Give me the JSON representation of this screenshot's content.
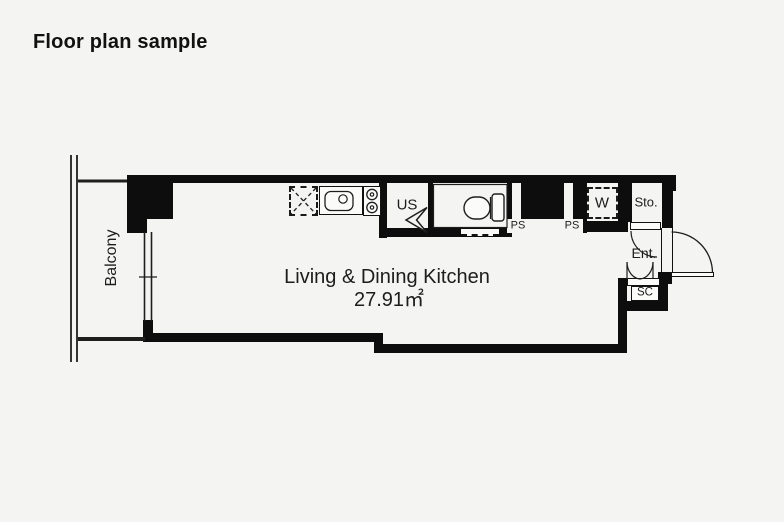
{
  "page": {
    "title": "Floor plan sample"
  },
  "colors": {
    "background": "#f4f4f2",
    "wall": "#0d0d0d",
    "line": "#222222",
    "fixture_fill": "#fbfbfa"
  },
  "floor_plan": {
    "balcony": "Balcony",
    "living_dining_kitchen": {
      "name": "Living & Dining Kitchen",
      "area": "27.91㎡"
    },
    "labels": {
      "us": "US",
      "ps_left": "PS",
      "ps_right": "PS",
      "w": "W",
      "storage": "Sto.",
      "entrance": "Ent.",
      "shoe_closet": "SC"
    }
  }
}
